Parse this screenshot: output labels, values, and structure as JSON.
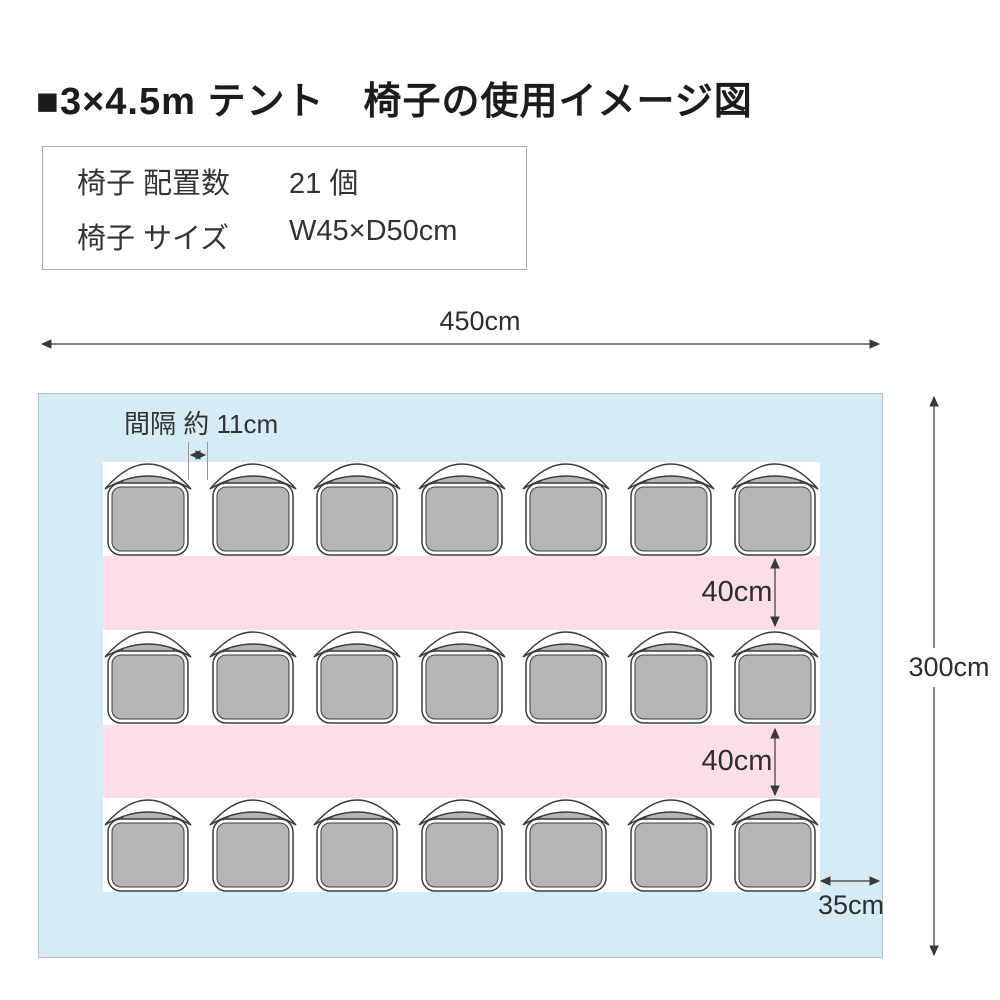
{
  "title": "■3×4.5m テント　椅子の使用イメージ図",
  "info_box": {
    "rows": [
      {
        "label": "椅子 配置数",
        "value": "21 個"
      },
      {
        "label": "椅子 サイズ",
        "value": "W45×D50cm"
      }
    ]
  },
  "diagram": {
    "tent_width_label": "450cm",
    "tent_height_label": "300cm",
    "aisle_gap_label": "40cm",
    "side_margin_label": "35cm",
    "chair_gap_label": "間隔 約 11cm",
    "rows": 3,
    "chairs_per_row": 7,
    "colors": {
      "tent": "#d5ecf7",
      "aisle": "#fcdde9",
      "chair_fill": "#b5b5b5",
      "chair_outline": "#3c3c3c",
      "dimension": "#3a3a3a"
    }
  }
}
